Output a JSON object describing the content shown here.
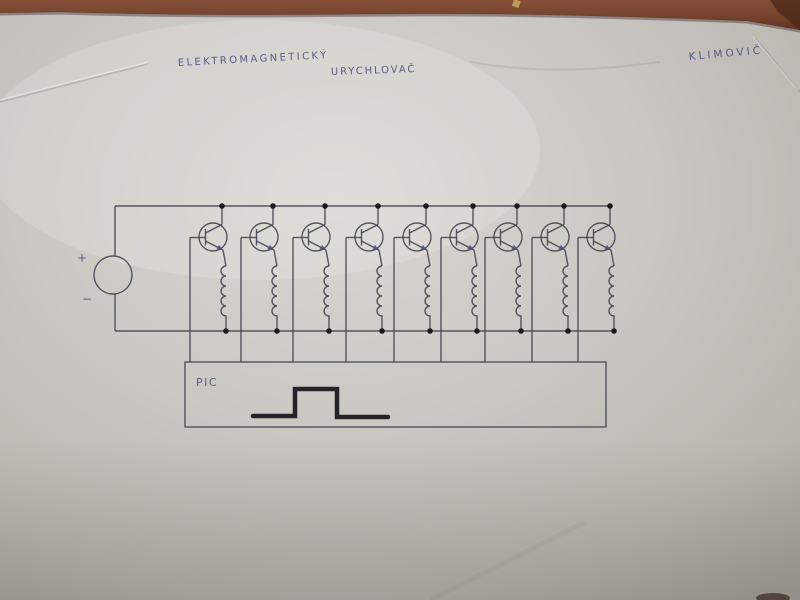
{
  "colors": {
    "table_brown": "#7a4630",
    "table_brown_dark": "#4a2718",
    "paper_light": "#d9d7d2",
    "paper_mid": "#c6c3be",
    "paper_dark": "#aaa7a1",
    "pencil_ink": "#41434e",
    "junction_dot": "#1a1a1d",
    "pen_blue": "#4e5187",
    "pulse_dark": "#242428"
  },
  "annotations": {
    "title_line1": "ELEKTROMAGNETICKÝ",
    "title_line2": "URYCHLOVAČ",
    "author": "KLIMOVIČ",
    "pic_label": "PIC",
    "source_plus": "+",
    "source_minus": "−"
  },
  "circuit": {
    "kind": "hand-drawn schematic: 9-stage electromagnetic accelerator (coilgun) driver with DC source, transistor+coil stages and PIC pulse controller",
    "stage_count": 9,
    "stage_x": [
      222,
      273,
      325,
      378,
      426,
      473,
      517,
      564,
      610
    ],
    "top_rail": {
      "y": 206,
      "x1": 115,
      "x2": 610
    },
    "bottom_rail": {
      "y": 331,
      "x1": 115,
      "x2": 616
    },
    "transistor": {
      "cy": 237,
      "r": 14
    },
    "coil": {
      "top_y": 266,
      "loops": 5,
      "loop_h": 10,
      "r": 5
    },
    "power_source": {
      "cx": 113,
      "cy": 275,
      "r": 19
    },
    "pic_box": {
      "x": 185,
      "y": 362,
      "w": 421,
      "h": 65
    },
    "pulse_points": [
      [
        253,
        416
      ],
      [
        295,
        416
      ],
      [
        295,
        389
      ],
      [
        337,
        389
      ],
      [
        337,
        417
      ],
      [
        388,
        417
      ]
    ],
    "pulse_width": 4.5,
    "dot_radius": 2.8
  }
}
